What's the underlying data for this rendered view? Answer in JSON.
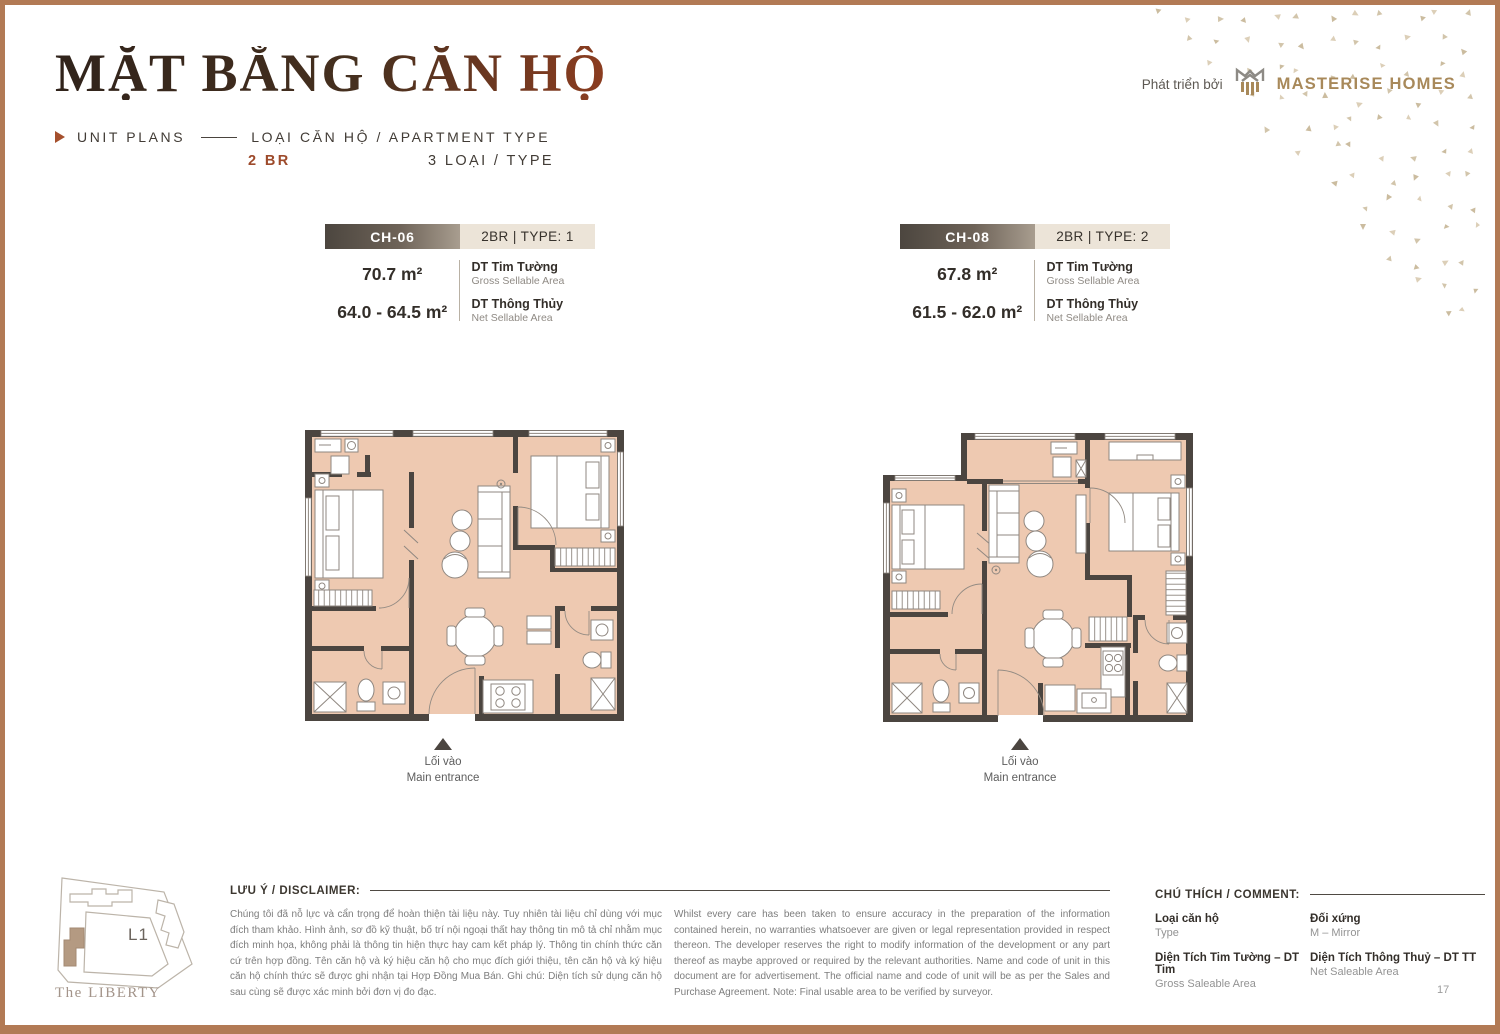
{
  "page": {
    "title": "MẶT BẰNG CĂN HỘ",
    "kicker": "UNIT PLANS",
    "kicker_right": "LOẠI CĂN HỘ / APARTMENT TYPE",
    "bedrooms": "2 BR",
    "type_count": "3 LOẠI / TYPE",
    "developer_prefix": "Phát triển bởi",
    "developer_name": "MASTERISE HOMES",
    "project_name": "The LIBERTY",
    "site_block_label": "L1",
    "page_number": "17"
  },
  "units": [
    {
      "code": "CH-06",
      "type_label": "2BR | TYPE: 1",
      "gross_area": "70.7 m²",
      "net_area": "64.0 - 64.5 m²",
      "gross_label": "DT Tim Tường",
      "gross_sub": "Gross Sellable Area",
      "net_label": "DT Thông Thủy",
      "net_sub": "Net Sellable Area",
      "entrance_vn": "Lối vào",
      "entrance_en": "Main entrance"
    },
    {
      "code": "CH-08",
      "type_label": "2BR | TYPE: 2",
      "gross_area": "67.8 m²",
      "net_area": "61.5 - 62.0 m²",
      "gross_label": "DT Tim Tường",
      "gross_sub": "Gross Sellable Area",
      "net_label": "DT Thông Thủy",
      "net_sub": "Net Sellable Area",
      "entrance_vn": "Lối vào",
      "entrance_en": "Main entrance"
    }
  ],
  "disclaimer": {
    "heading": "LƯU Ý / DISCLAIMER:",
    "vn": "Chúng tôi đã nỗ lực và cẩn trọng để hoàn thiện tài liệu này. Tuy nhiên tài liệu chỉ dùng với mục đích tham khảo. Hình ảnh, sơ đồ kỹ thuật, bố trí nội ngoại thất hay thông tin mô tả chỉ nhằm mục đích minh họa, không phải là thông tin hiện thực hay cam kết pháp lý. Thông tin chính thức căn cứ trên hợp đồng. Tên căn hộ và ký hiệu căn hộ cho mục đích giới thiệu, tên căn hộ và ký hiệu căn hộ chính thức sẽ được ghi nhận tại Hợp Đồng Mua Bán. Ghi chú: Diện tích sử dụng căn hộ sau cùng sẽ được xác minh bởi đơn vị đo đạc.",
    "en": "Whilst every care has been taken to ensure accuracy in the preparation of the information contained herein, no warranties whatsoever are given or legal representation provided in respect thereon. The developer reserves the right to modify information of the development or any part thereof as maybe approved or required by the relevant authorities. Name and code of unit in this document are for advertisement. The official name and code of unit will be as per the Sales and Purchase Agreement. Note: Final usable area to be verified by surveyor."
  },
  "legend": {
    "heading": "CHÚ THÍCH / COMMENT:",
    "items": [
      {
        "label": "Loại căn hộ",
        "sub": "Type"
      },
      {
        "label": "Đối xứng",
        "sub": "M – Mirror"
      },
      {
        "label": "Diện Tích Tim Tường – DT Tim",
        "sub": "Gross Saleable Area"
      },
      {
        "label": "Diện Tích Thông Thuỷ – DT TT",
        "sub": "Net Saleable Area"
      }
    ]
  },
  "colors": {
    "accent": "#9d4a2b",
    "frame": "#b27a55",
    "floor": "#eec9b1",
    "wall": "#4b4540",
    "bar_beige": "#ece4d8",
    "brand_gold": "#a8895a"
  }
}
